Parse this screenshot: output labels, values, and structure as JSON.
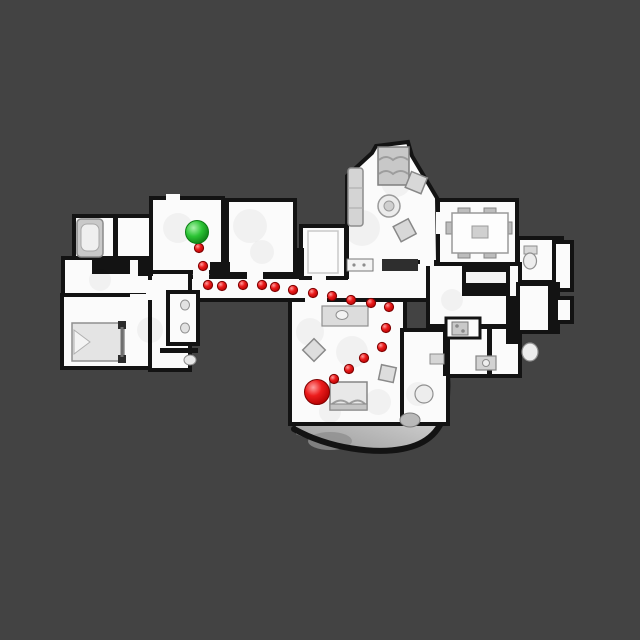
{
  "scene": {
    "background_color": "#434343",
    "floor_color": "#fbfbfb",
    "wall_color": "#131313",
    "terrace_dark": "#9a9a9a",
    "terrace_light": "#e9e9e9"
  },
  "markers": {
    "goal": {
      "label": "goal",
      "color": "#2fca2f",
      "edge_color": "#0c7d14",
      "x": 197,
      "y": 232,
      "radius": 11.5
    },
    "agent": {
      "label": "agent",
      "color": "#e31212",
      "edge_color": "#7e0000",
      "x": 317,
      "y": 392,
      "radius": 12.5
    },
    "trail": {
      "color": "#e31212",
      "edge_color": "#7e0000",
      "dot_radius": 4.6,
      "points": [
        [
          199,
          248
        ],
        [
          203,
          266
        ],
        [
          208,
          285
        ],
        [
          222,
          286
        ],
        [
          243,
          285
        ],
        [
          262,
          285
        ],
        [
          275,
          287
        ],
        [
          293,
          290
        ],
        [
          313,
          293
        ],
        [
          332,
          296
        ],
        [
          351,
          300
        ],
        [
          371,
          303
        ],
        [
          389,
          307
        ],
        [
          386,
          328
        ],
        [
          382,
          347
        ],
        [
          364,
          358
        ],
        [
          349,
          369
        ],
        [
          334,
          379
        ]
      ]
    }
  }
}
